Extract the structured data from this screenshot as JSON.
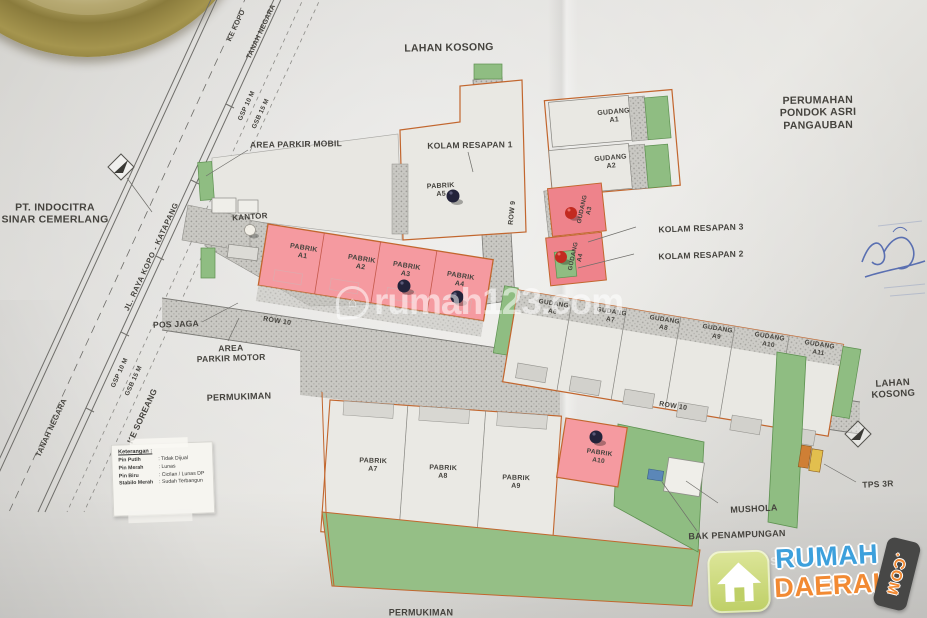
{
  "surroundings": {
    "lahan_kosong": "LAHAN KOSONG",
    "permukiman": "PERMUKIMAN",
    "pt_indocitra": "PT. INDOCITRA\nSINAR CEMERLANG",
    "perumahan": "PERUMAHAN\nPONDOK ASRI PANGAUBAN"
  },
  "roads": {
    "to_kopo": "KE KOPO",
    "to_soreang": "KE SOREANG",
    "tanah_negara": "TANAH NEGARA",
    "main_road_name": "JL. RAYA KOPO - KATAPANG",
    "gsp": "GSP  10 M",
    "gsb": "GSB  15 M",
    "row9": "ROW 9",
    "row10": "ROW 10"
  },
  "facilities": {
    "area_parkir_mobil": "AREA PARKIR MOBIL",
    "area_parkir_motor": "AREA\nPARKIR MOTOR",
    "kolam_resapan_1": "KOLAM RESAPAN 1",
    "kolam_resapan_2": "KOLAM RESAPAN 2",
    "kolam_resapan_3": "KOLAM RESAPAN 3",
    "kantor": "KANTOR",
    "pos_jaga": "POS JAGA",
    "mushola": "MUSHOLA",
    "bak_penampungan": "BAK PENAMPUNGAN",
    "tps_3r": "TPS 3R"
  },
  "units": {
    "pabrik_row": [
      {
        "label": "PABRIK\nA1",
        "pin": "none",
        "highlighted": true
      },
      {
        "label": "PABRIK\nA2",
        "pin": "none",
        "highlighted": true
      },
      {
        "label": "PABRIK\nA3",
        "pin": "dark-blue",
        "highlighted": true
      },
      {
        "label": "PABRIK\nA4",
        "pin": "dark-blue",
        "highlighted": true
      }
    ],
    "pabrik_top": {
      "label": "PABRIK\nA5",
      "pin": "dark-blue",
      "highlighted": false
    },
    "pabrik_bottom": [
      {
        "label": "PABRIK\nA7",
        "pin": "none",
        "highlighted": false
      },
      {
        "label": "PABRIK\nA8",
        "pin": "none",
        "highlighted": false
      },
      {
        "label": "PABRIK\nA9",
        "pin": "none",
        "highlighted": false
      }
    ],
    "pabrik_a10": {
      "label": "PABRIK\nA10",
      "pin": "dark-blue",
      "highlighted": true
    },
    "gudang_top": [
      {
        "label": "GUDANG\nA1",
        "pin": "none",
        "highlighted": false
      },
      {
        "label": "GUDANG\nA2",
        "pin": "none",
        "highlighted": false
      }
    ],
    "gudang_pink": [
      {
        "label": "GUDANG\nA3",
        "pin": "red",
        "highlighted": true
      },
      {
        "label": "GUDANG\nA4",
        "pin": "red",
        "highlighted": true
      }
    ],
    "gudang_row": [
      {
        "label": "GUDANG\nA6",
        "pin": "none",
        "highlighted": false
      },
      {
        "label": "GUDANG\nA7",
        "pin": "none",
        "highlighted": false
      },
      {
        "label": "GUDANG\nA8",
        "pin": "none",
        "highlighted": false
      },
      {
        "label": "GUDANG\nA9",
        "pin": "none",
        "highlighted": false
      },
      {
        "label": "GUDANG\nA10",
        "pin": "none",
        "highlighted": false
      },
      {
        "label": "GUDANG\nA11",
        "pin": "none",
        "highlighted": false
      }
    ]
  },
  "legend": {
    "title": "Keterangan :",
    "rows": [
      {
        "key": "Pin Putih",
        "value": ": Tidak Dijual"
      },
      {
        "key": "Pin Merah",
        "value": ": Lunas"
      },
      {
        "key": "Pin Biru",
        "value": ": Cicilan / Lunas DP"
      },
      {
        "key": "Stabilo Merah",
        "value": ": Sudah Terbangun"
      }
    ]
  },
  "watermark": {
    "text": "rumah123.com"
  },
  "logo": {
    "line1": "RUMAH",
    "line2": "DAERAH",
    "tld": ".COM"
  },
  "colors": {
    "highlight_pink": "#f59aa0",
    "unit_fill": "#eae9e4",
    "green": "#8fbd82",
    "road_hatch": "#c9c8c3",
    "site_outline": "#c2662e",
    "pin_dark": "#23233a",
    "pin_red": "#c22a20",
    "pin_white": "#f1eee6"
  }
}
